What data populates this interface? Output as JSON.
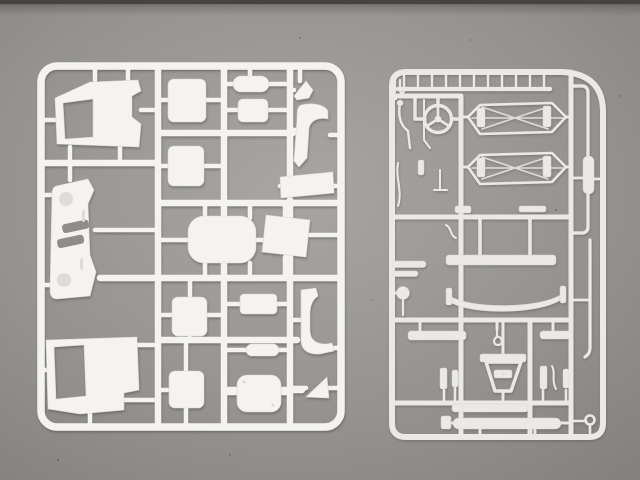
{
  "scene": {
    "description": "Photograph of two white plastic model-kit sprues (injection-molded part trees for a truck model) lying on a warm gray cardboard surface, lit from above with a dark band along the very top edge.",
    "colors": {
      "surface": "#a7a5a1",
      "surface_dim": "#8f8d89",
      "surface_dark": "#7b7976",
      "topband": "#454443",
      "plastic": "#f4f3f0",
      "plastic_dim": "#eae9e5",
      "plastic_edge": "#d8d7d3",
      "plastic_deep": "#dedcd8",
      "shadow": "#3a3835"
    },
    "sprues": {
      "left": {
        "label": "Left sprue - cab body panels",
        "parts": [
          "cab side panel with window opening (upper)",
          "seat backrest square (upper)",
          "small pill panel",
          "small rectangular panel",
          "arrow-shaped bracket",
          "curved fender (upper right)",
          "seat backrest square (lower)",
          "slanted flat panel",
          "front grille panel with two headlight recesses and louver slots",
          "rounded roof panel",
          "trapezoid engine-cover panel",
          "seat cushion square (upper)",
          "small rectangular plate",
          "small pill plate",
          "seat cushion square (lower)",
          "rounded hatch cover with rivet marks",
          "cab side panel with window opening (lower)",
          "J-shaped rear fender",
          "triangular gusset plate"
        ]
      },
      "right": {
        "label": "Right sprue - chassis and detail parts",
        "parts": [
          "row of eleven small clamp fittings",
          "double hook fitting",
          "three-spoke steering wheel",
          "upper chassis rail with leaf-spring lattice",
          "lower chassis rail with leaf-spring lattice",
          "bent brake lines and small rods",
          "short tie bars",
          "front bumper bar",
          "bowed leaf spring",
          "mirror head on stem",
          "cross-member bars with center hook",
          "A-frame tow hitch",
          "small brackets and levers",
          "lower cross bar",
          "rear bumper bar with end cap",
          "exhaust pipe with muffler",
          "corner hook shackle"
        ]
      }
    }
  }
}
